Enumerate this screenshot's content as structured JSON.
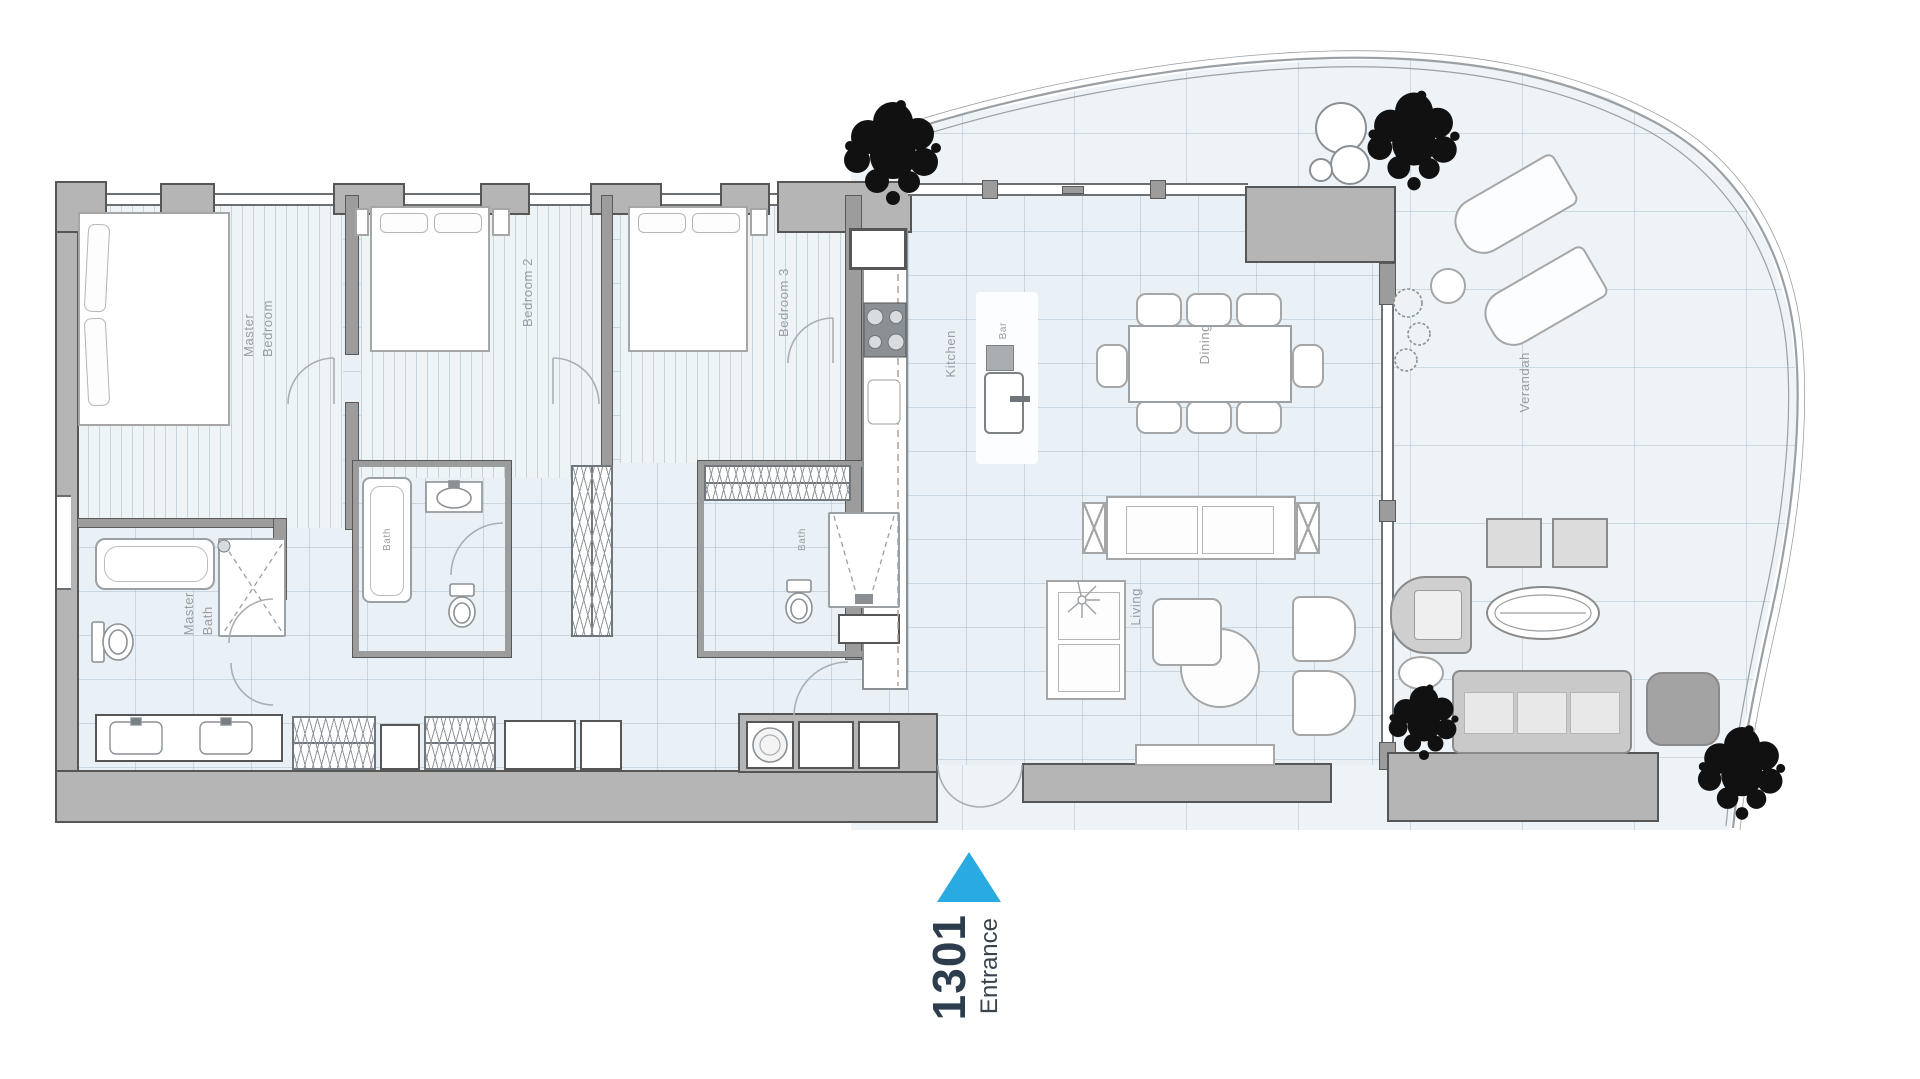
{
  "unit": {
    "number": "1301",
    "entrance_label": "Entrance"
  },
  "rooms": {
    "master_bedroom": "Master\nBedroom",
    "bedroom2": "Bedroom 2",
    "bedroom3": "Bedroom 3",
    "master_bath": "Master\nBath",
    "bath2": "Bath",
    "bath3": "Bath",
    "kitchen": "Kitchen",
    "bar": "Bar",
    "dining": "Dining",
    "living": "Living",
    "verandah": "Verandah"
  },
  "colors": {
    "accent_triangle": "#29abe2",
    "unit_number_text": "#2e3d4e",
    "entrance_text": "#3a434c",
    "wall_fill": "#b5b5b5",
    "wall_outline": "#565656",
    "room_label_text": "#979da2",
    "tree": "#111111",
    "floor_tile": "#e9f1f6",
    "floor_wood": "#eef3f6"
  }
}
